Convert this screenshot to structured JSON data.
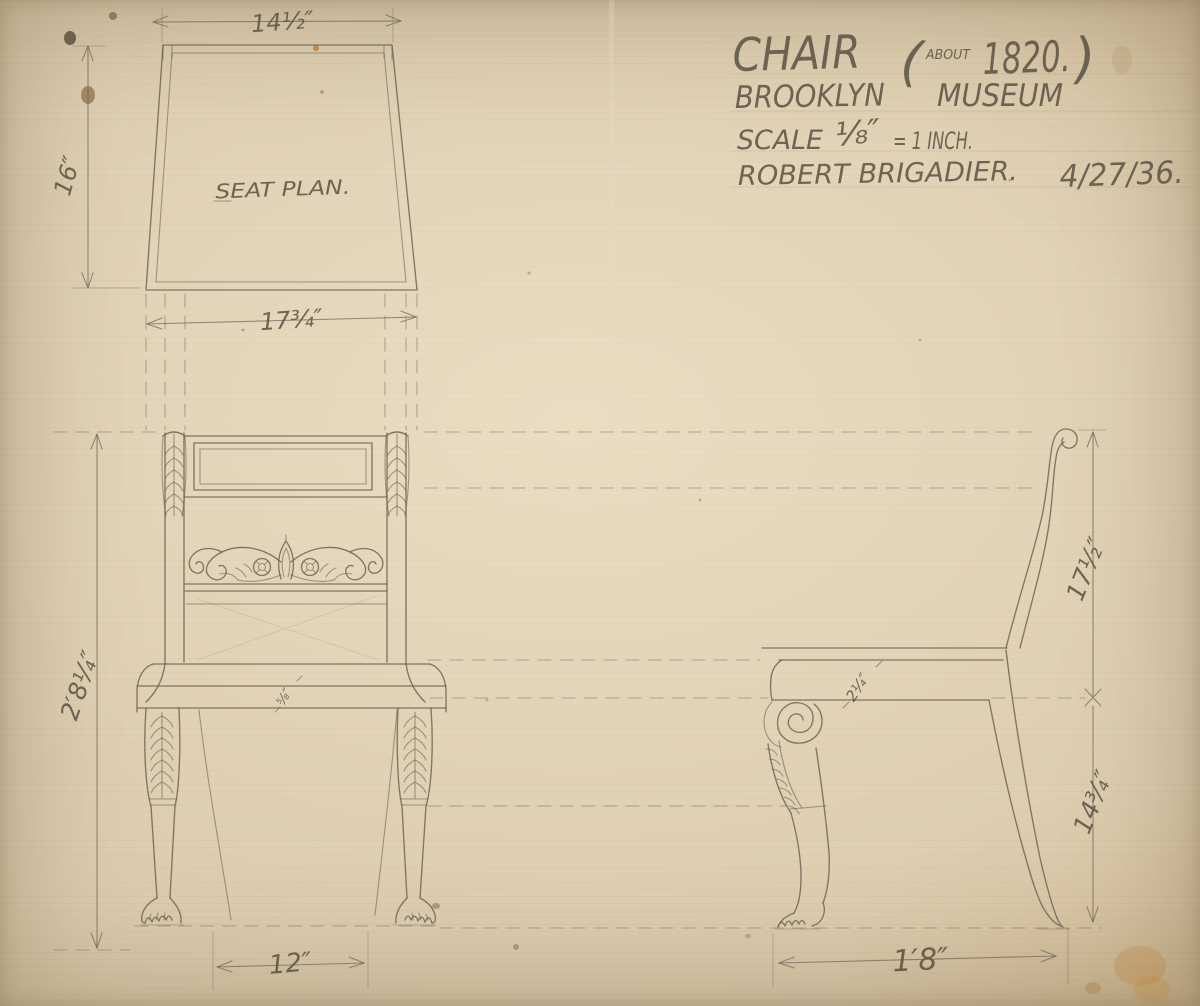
{
  "palette": {
    "paper": "#d9c9ab",
    "graphite": "#5d5547",
    "stain_orange": "#b97f35"
  },
  "title_block": {
    "object": "CHAIR",
    "paren_open": "(",
    "circa": "ABOUT",
    "year": "1820.",
    "paren_close": ")",
    "museum_word1": "BROOKLYN",
    "museum_word2": "MUSEUM",
    "scale_word": "SCALE",
    "scale_fraction": "⅛″",
    "scale_rest": "= 1 INCH.",
    "artist": "ROBERT BRIGADIER.",
    "date": "4/27/36."
  },
  "labels": {
    "seat_plan": "SEAT PLAN."
  },
  "dimensions": {
    "seat_plan_front_width": "14½″",
    "seat_plan_depth": "16″",
    "seat_plan_back_width": "17¾″",
    "overall_height": "2′8¼″",
    "front_leg_spread": "12″",
    "back_height_above_seat": "17½″",
    "seat_height": "14¾″",
    "overall_depth": "1′8″",
    "side_seat_rail": "2¼″",
    "front_seat_rail": "⅝″"
  }
}
